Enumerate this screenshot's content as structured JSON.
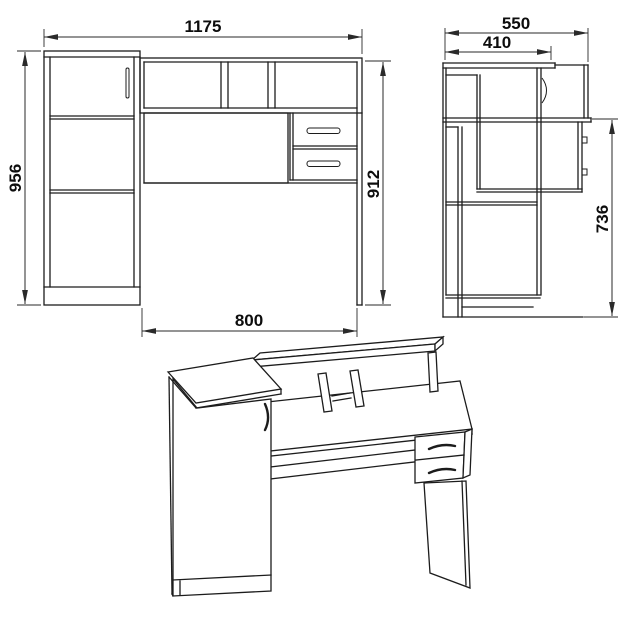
{
  "drawing": {
    "type": "furniture-technical-drawing",
    "line_color": "#1c1c1c",
    "background": "#ffffff"
  },
  "views": {
    "front": {
      "dims": {
        "width_top": "1175",
        "height_left": "956",
        "height_right": "912",
        "width_bottom": "800"
      }
    },
    "side": {
      "dims": {
        "depth_top": "550",
        "depth_inner": "410",
        "height_right": "736"
      }
    }
  }
}
